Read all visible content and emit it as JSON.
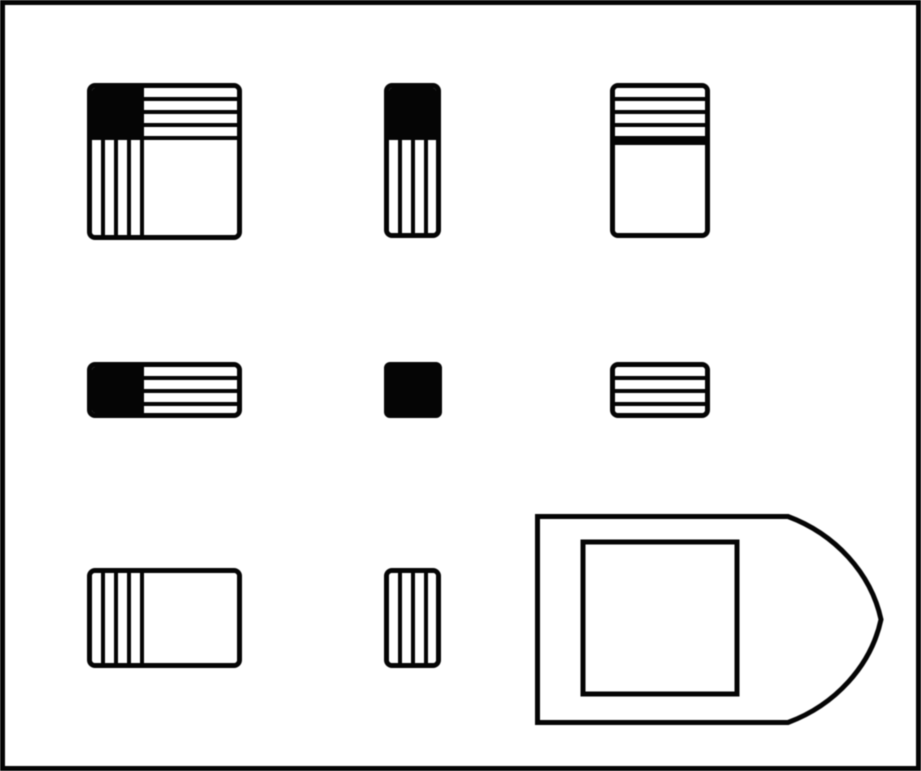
{
  "figure": {
    "type": "matrix-reasoning-puzzle",
    "description": "3x3 Raven-style matrix of black/white patterned rectangles with a right-pointing answer tag containing a blank square",
    "ink_color": "#050505",
    "paper_color": "#ffffff",
    "patterns_legend": {
      "solid-black": "filled black region",
      "horizontal-stripes": "4 white horizontal bars on black",
      "vertical-stripes": "4 white vertical bars on black",
      "blank-white": "empty white region with black outline"
    },
    "grid": {
      "rows": 3,
      "cols": 3,
      "cells": [
        {
          "row": 1,
          "col": 1,
          "shape": "large-square",
          "regions": [
            {
              "position": "top-left",
              "pattern": "solid-black"
            },
            {
              "position": "top-right",
              "pattern": "horizontal-stripes",
              "white_bar_count": 4
            },
            {
              "position": "bottom-left",
              "pattern": "vertical-stripes",
              "white_bar_count": 4
            },
            {
              "position": "bottom-right",
              "pattern": "blank-white"
            }
          ]
        },
        {
          "row": 1,
          "col": 2,
          "shape": "tall-rectangle",
          "regions": [
            {
              "position": "top",
              "pattern": "solid-black"
            },
            {
              "position": "bottom",
              "pattern": "vertical-stripes",
              "white_bar_count": 4
            }
          ]
        },
        {
          "row": 1,
          "col": 3,
          "shape": "tall-rectangle",
          "regions": [
            {
              "position": "top",
              "pattern": "horizontal-stripes",
              "white_bar_count": 4
            },
            {
              "position": "bottom",
              "pattern": "blank-white"
            }
          ]
        },
        {
          "row": 2,
          "col": 1,
          "shape": "wide-rectangle",
          "regions": [
            {
              "position": "left",
              "pattern": "solid-black"
            },
            {
              "position": "right",
              "pattern": "horizontal-stripes",
              "white_bar_count": 4
            }
          ]
        },
        {
          "row": 2,
          "col": 2,
          "shape": "small-square",
          "regions": [
            {
              "position": "full",
              "pattern": "solid-black"
            }
          ]
        },
        {
          "row": 2,
          "col": 3,
          "shape": "small-rectangle",
          "regions": [
            {
              "position": "full",
              "pattern": "horizontal-stripes",
              "white_bar_count": 4
            }
          ]
        },
        {
          "row": 3,
          "col": 1,
          "shape": "wide-rectangle",
          "regions": [
            {
              "position": "left",
              "pattern": "vertical-stripes",
              "white_bar_count": 4
            },
            {
              "position": "right",
              "pattern": "blank-white"
            }
          ]
        },
        {
          "row": 3,
          "col": 2,
          "shape": "small-rectangle",
          "regions": [
            {
              "position": "full",
              "pattern": "vertical-stripes",
              "white_bar_count": 4
            }
          ]
        },
        {
          "row": 3,
          "col": 3,
          "shape": "answer-pointer",
          "regions": [
            {
              "position": "full",
              "pattern": "blank-white-square-inside-right-pointing-tag"
            }
          ]
        }
      ]
    },
    "answer_pointer": {
      "shape": "right-pointing-tag-outline",
      "tip_direction": "right",
      "contains": "blank-white-square-outline"
    }
  }
}
